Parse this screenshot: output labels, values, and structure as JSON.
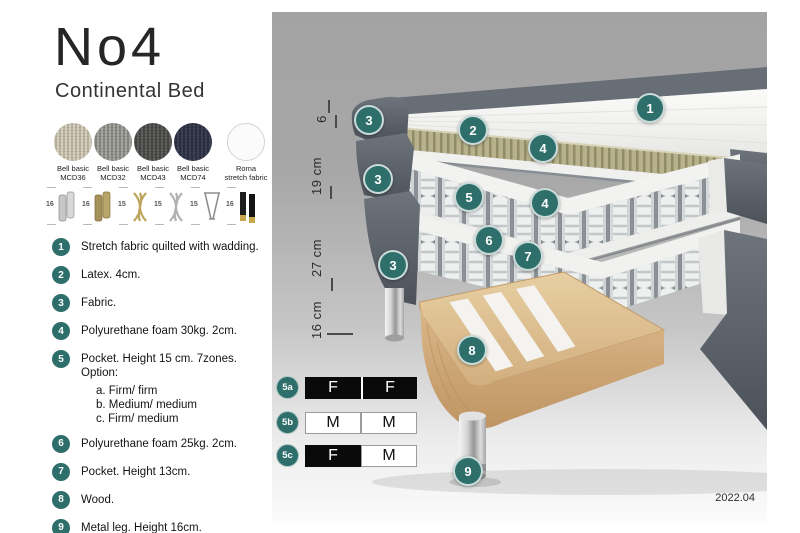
{
  "header": {
    "title": "No4",
    "subtitle": "Continental Bed"
  },
  "fabrics": {
    "items": [
      {
        "line1": "Bell basic",
        "line2": "MCD36",
        "color": "#d9d3c5"
      },
      {
        "line1": "Bell basic",
        "line2": "MCD32",
        "color": "#a9a9a5"
      },
      {
        "line1": "Bell basic",
        "line2": "MCD43",
        "color": "#616160"
      },
      {
        "line1": "Bell basic",
        "line2": "MCD74",
        "color": "#3e4357"
      },
      {
        "line1": "Roma",
        "line2": "stretch fabric",
        "color": "#fbfbfb"
      }
    ]
  },
  "legs": {
    "items": [
      {
        "height": "16",
        "style": "chrome cylinder"
      },
      {
        "height": "16",
        "style": "brass cylinder"
      },
      {
        "height": "15",
        "style": "gold twisted"
      },
      {
        "height": "15",
        "style": "silver twisted"
      },
      {
        "height": "15",
        "style": "hairpin"
      },
      {
        "height": "16",
        "style": "black with brass tip"
      }
    ]
  },
  "spec_list": {
    "items": [
      {
        "num": "1",
        "text": "Stretch fabric quilted with wadding."
      },
      {
        "num": "2",
        "text": "Latex. 4cm."
      },
      {
        "num": "3",
        "text": "Fabric."
      },
      {
        "num": "4",
        "text": "Polyurethane foam 30kg. 2cm."
      },
      {
        "num": "5",
        "text": "Pocket. Height 15 cm. 7zones. Option:",
        "options": [
          "a. Firm/ firm",
          "b. Medium/ medium",
          "c. Firm/ medium"
        ]
      },
      {
        "num": "6",
        "text": "Polyurethane foam 25kg. 2cm."
      },
      {
        "num": "7",
        "text": "Pocket. Height 13cm."
      },
      {
        "num": "8",
        "text": "Wood."
      },
      {
        "num": "9",
        "text": "Metal leg. Height 16cm."
      }
    ]
  },
  "dimensions": {
    "labels": [
      "6",
      "19 cm",
      "27 cm",
      "16 cm"
    ]
  },
  "illustration": {
    "badges": [
      {
        "label": "1"
      },
      {
        "label": "2"
      },
      {
        "label": "3"
      },
      {
        "label": "3"
      },
      {
        "label": "3"
      },
      {
        "label": "4"
      },
      {
        "label": "4"
      },
      {
        "label": "5"
      },
      {
        "label": "6"
      },
      {
        "label": "7"
      },
      {
        "label": "8"
      },
      {
        "label": "9"
      }
    ]
  },
  "firmness": {
    "rows": [
      {
        "id": "5a",
        "cells": [
          {
            "letter": "F",
            "tone": "dark"
          },
          {
            "letter": "F",
            "tone": "dark"
          }
        ]
      },
      {
        "id": "5b",
        "cells": [
          {
            "letter": "M",
            "tone": "light"
          },
          {
            "letter": "M",
            "tone": "light"
          }
        ]
      },
      {
        "id": "5c",
        "cells": [
          {
            "letter": "F",
            "tone": "dark"
          },
          {
            "letter": "M",
            "tone": "light"
          }
        ]
      }
    ]
  },
  "footer": {
    "version": "2022.04"
  },
  "colors": {
    "badge_teal": "#2e6f6b",
    "dark_fabric": "#5d636c",
    "latex": "#b7b18c",
    "wood": "#d9ba8c"
  }
}
